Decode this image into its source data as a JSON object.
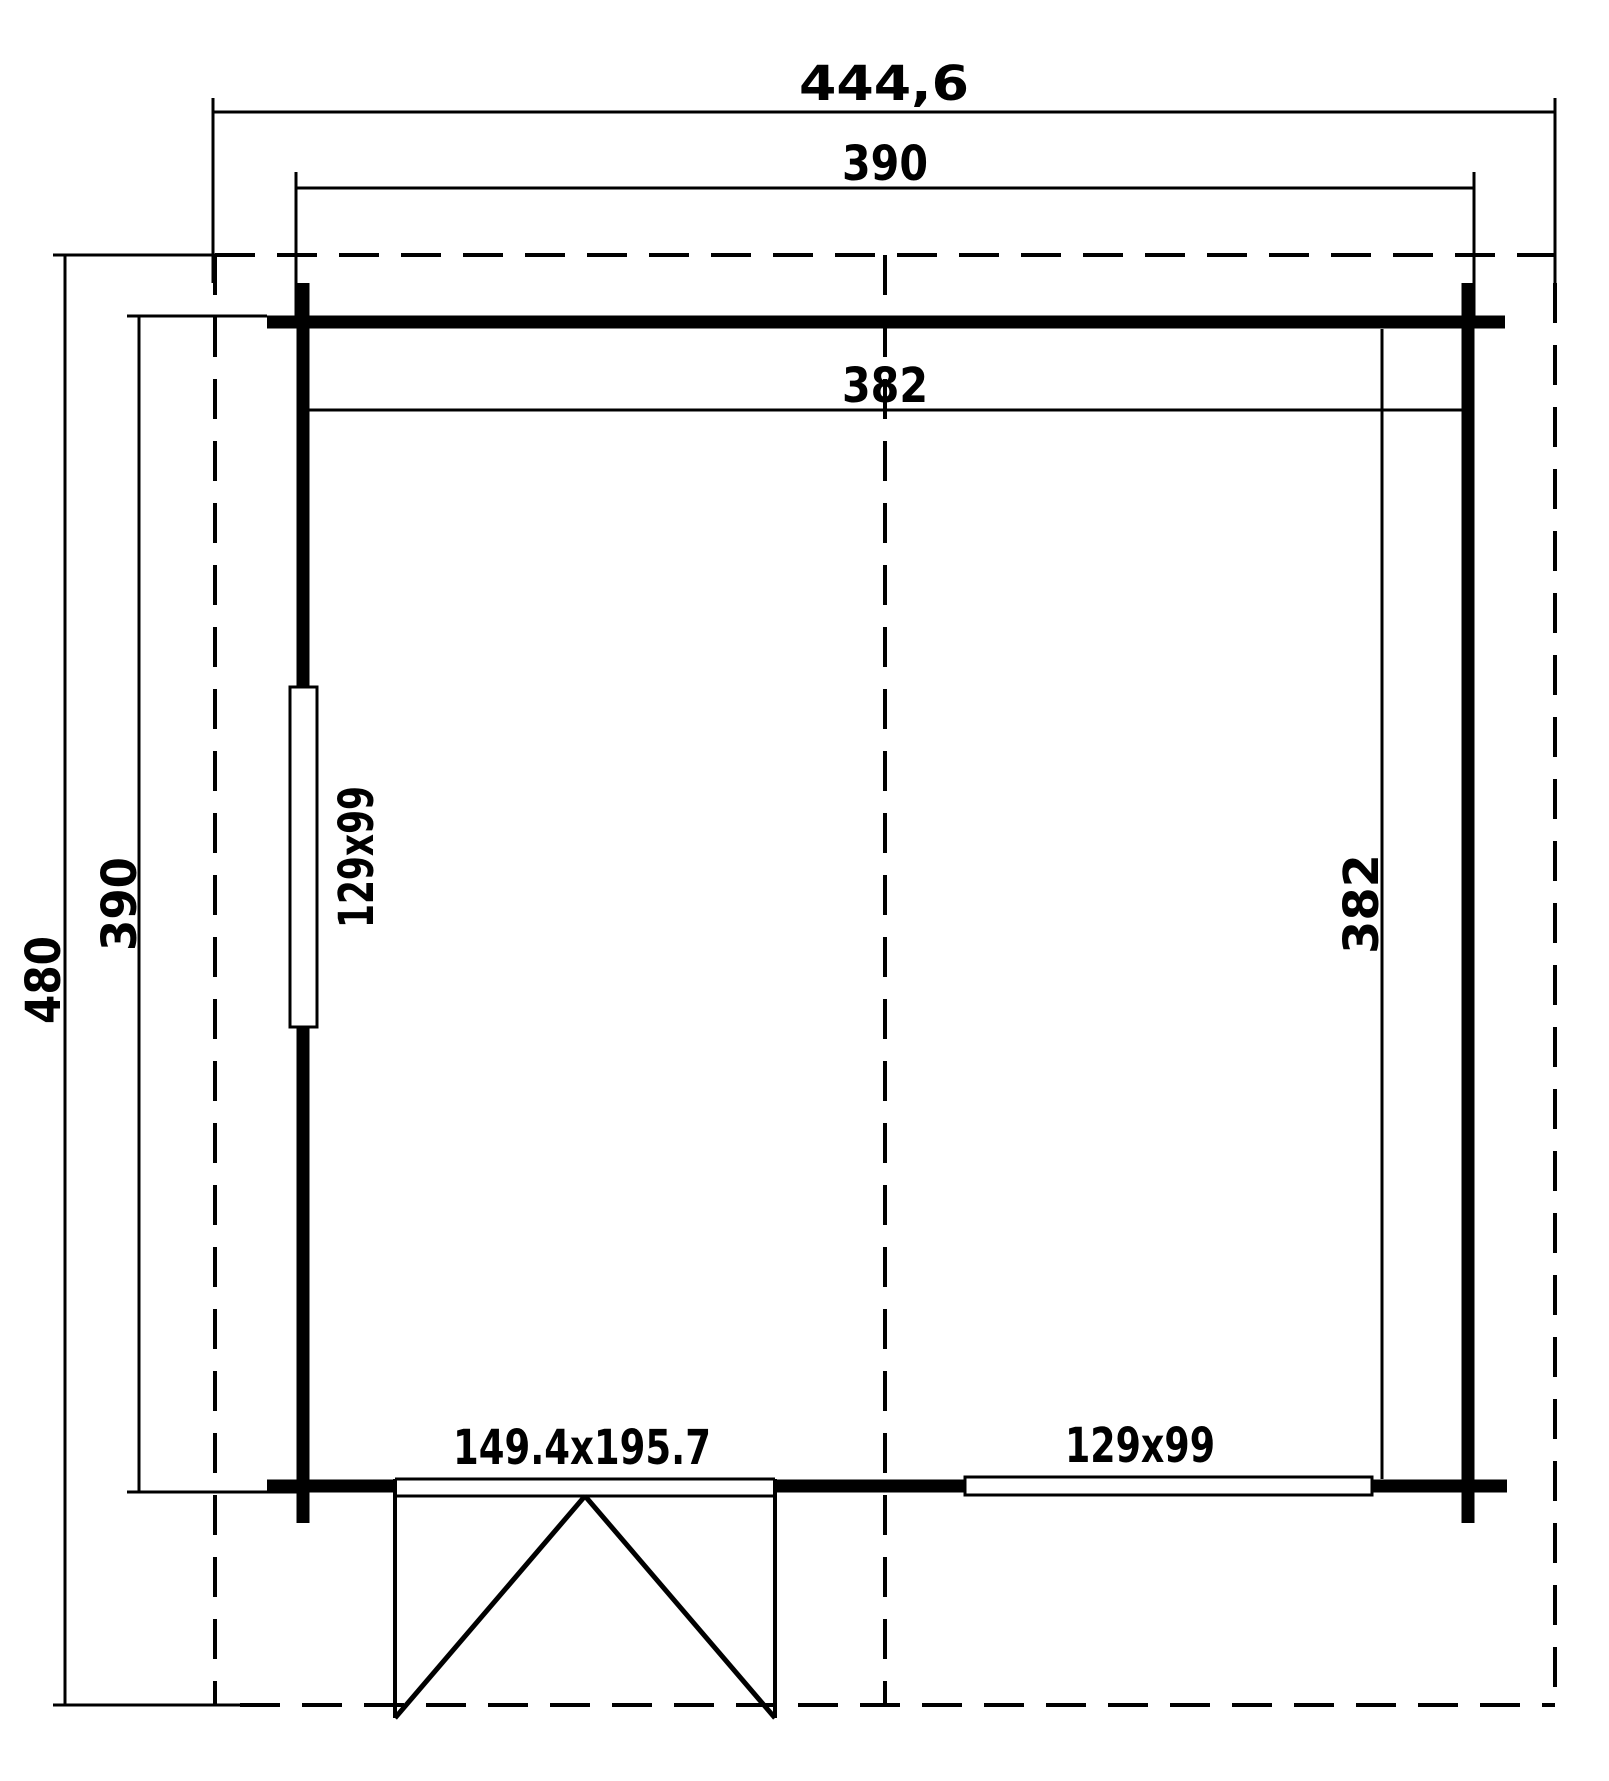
{
  "drawing": {
    "type": "floor-plan",
    "colors": {
      "line": "#000000",
      "background": "#ffffff"
    },
    "dimensions": {
      "overall_width": "444,6",
      "building_width": "390",
      "interior_width": "382",
      "overall_depth": "480",
      "building_depth": "390",
      "interior_depth": "382"
    },
    "openings": {
      "left_window": "129x99",
      "bottom_window": "129x99",
      "door": "149.4x195.7"
    }
  }
}
